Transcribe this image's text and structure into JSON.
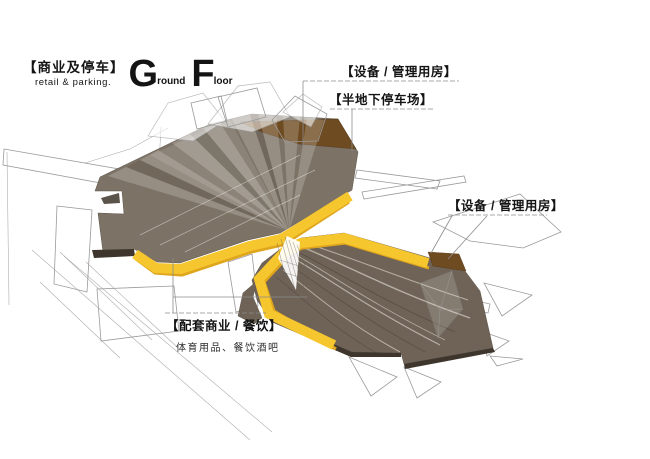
{
  "title": {
    "cjk": "【商业及停车】",
    "en": "retail & parking.",
    "floor_big1": "G",
    "floor_small1": "round",
    "floor_big2": "F",
    "floor_small2": "loor"
  },
  "callouts": {
    "equipment_top": {
      "text": "【设备 / 管理用房】"
    },
    "parking": {
      "text": "【半地下停车场】"
    },
    "equipment_right": {
      "text": "【设备 / 管理用房】"
    },
    "retail": {
      "text": "【配套商业 / 餐饮】",
      "sub": "体育用品、餐饮酒吧"
    }
  },
  "colors": {
    "mass_brown": "#7C7265",
    "mass_brown_dark": "#6E6356",
    "mass_edge_dark": "#3E362C",
    "service_brown": "#6F4B21",
    "band_yellow": "#F6C62F",
    "band_yellow_dark": "#DFA51C",
    "wire_gray": "#9A9A9A",
    "leader_gray": "#8C8C8C",
    "text_black": "#141414"
  }
}
